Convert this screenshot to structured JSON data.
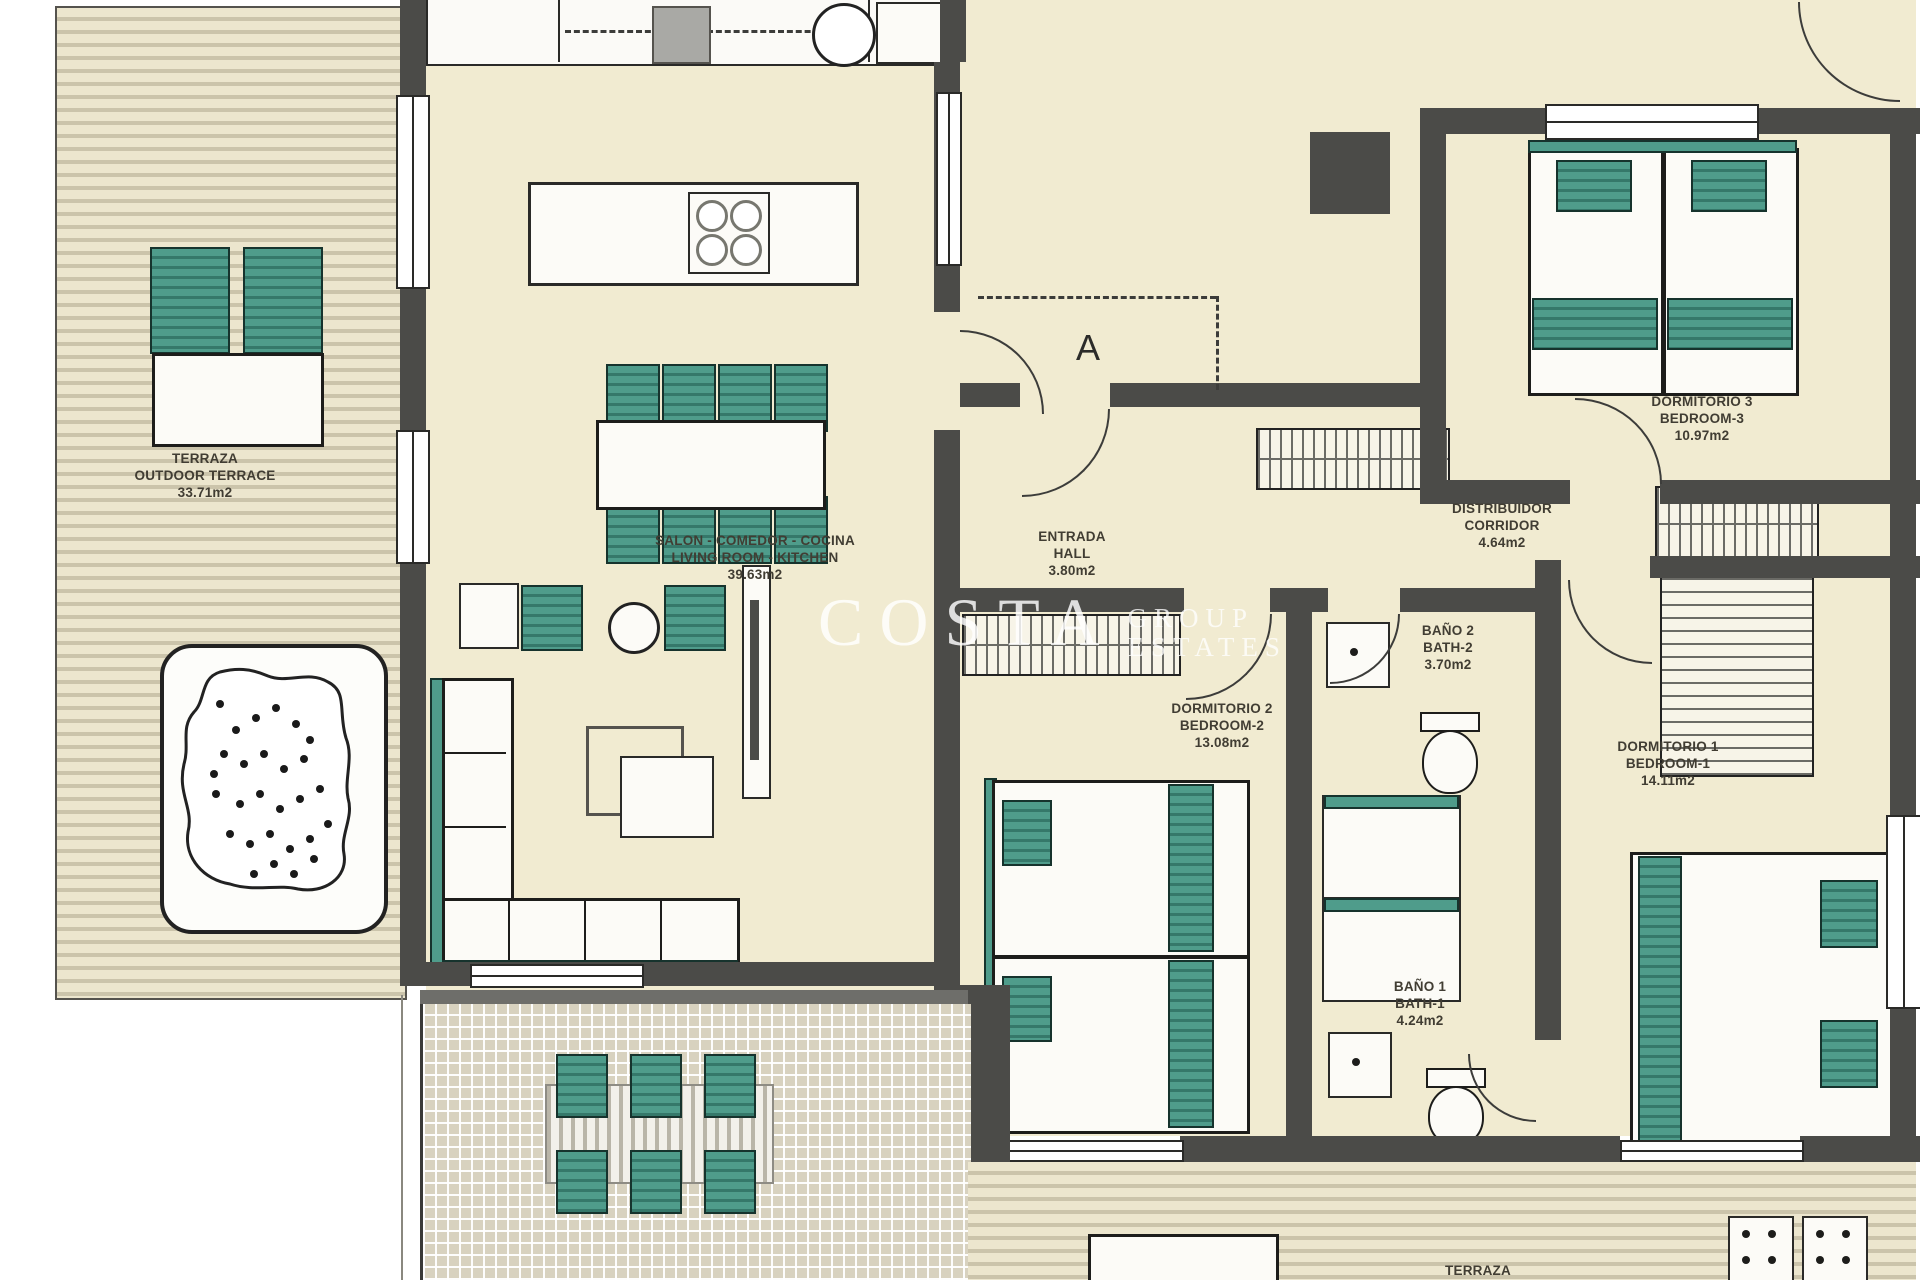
{
  "watermark": {
    "brand": "COSTA",
    "sub1": "GROUP",
    "sub2": "ESTATES"
  },
  "section_label": "A",
  "rooms": {
    "terrace_left": {
      "name_es": "TERRAZA",
      "name_en": "OUTDOOR TERRACE",
      "area": "33.71m2"
    },
    "living": {
      "name_es": "SALON - COMEDOR - COCINA",
      "name_en": "LIVING ROOM - KITCHEN",
      "area": "39.63m2"
    },
    "hall": {
      "name_es": "ENTRADA",
      "name_en": "HALL",
      "area": "3.80m2"
    },
    "corridor": {
      "name_es": "DISTRIBUIDOR",
      "name_en": "CORRIDOR",
      "area": "4.64m2"
    },
    "bedroom3": {
      "name_es": "DORMITORIO 3",
      "name_en": "BEDROOM-3",
      "area": "10.97m2"
    },
    "bedroom2": {
      "name_es": "DORMITORIO 2",
      "name_en": "BEDROOM-2",
      "area": "13.08m2"
    },
    "bath2": {
      "name_es": "BAÑO 2",
      "name_en": "BATH-2",
      "area": "3.70m2"
    },
    "bedroom1": {
      "name_es": "DORMITORIO 1",
      "name_en": "BEDROOM-1",
      "area": "14.11m2"
    },
    "bath1": {
      "name_es": "BAÑO 1",
      "name_en": "BATH-1",
      "area": "4.24m2"
    },
    "terrace_bottom": {
      "name_es": "TERRAZA"
    }
  },
  "colors": {
    "cream": "#f1ebd1",
    "wall": "#4b4b48",
    "teal": "#4f9c8b",
    "tealDark": "#35786a",
    "stripeLight": "#ece6ce",
    "stripeDark": "#cbc4ab",
    "pergola": "#d8d2bf"
  }
}
